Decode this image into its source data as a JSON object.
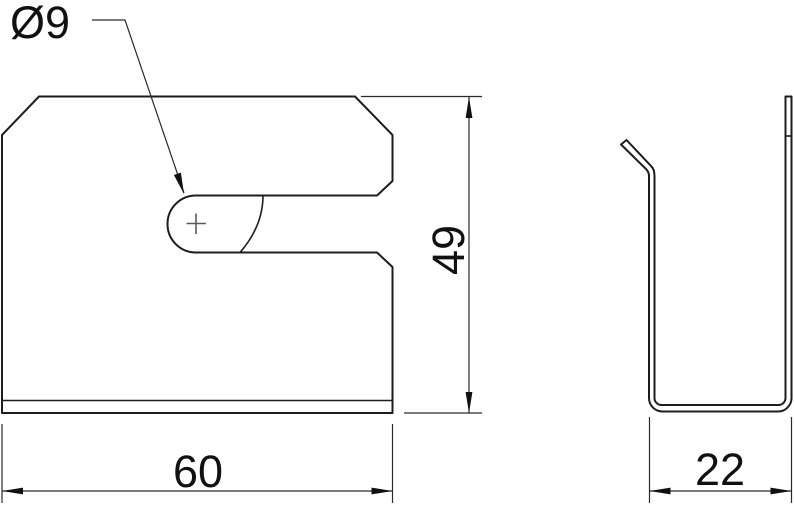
{
  "front_view": {
    "diameter_label": "Ø9",
    "width_label": "60",
    "height_label": "49"
  },
  "side_view": {
    "depth_label": "22"
  },
  "colors": {
    "line": "#1d1d1d",
    "dimension_line": "#2a2a2a",
    "center_mark": "#5a5a5a",
    "arrow": "#111111",
    "background": "#ffffff"
  }
}
